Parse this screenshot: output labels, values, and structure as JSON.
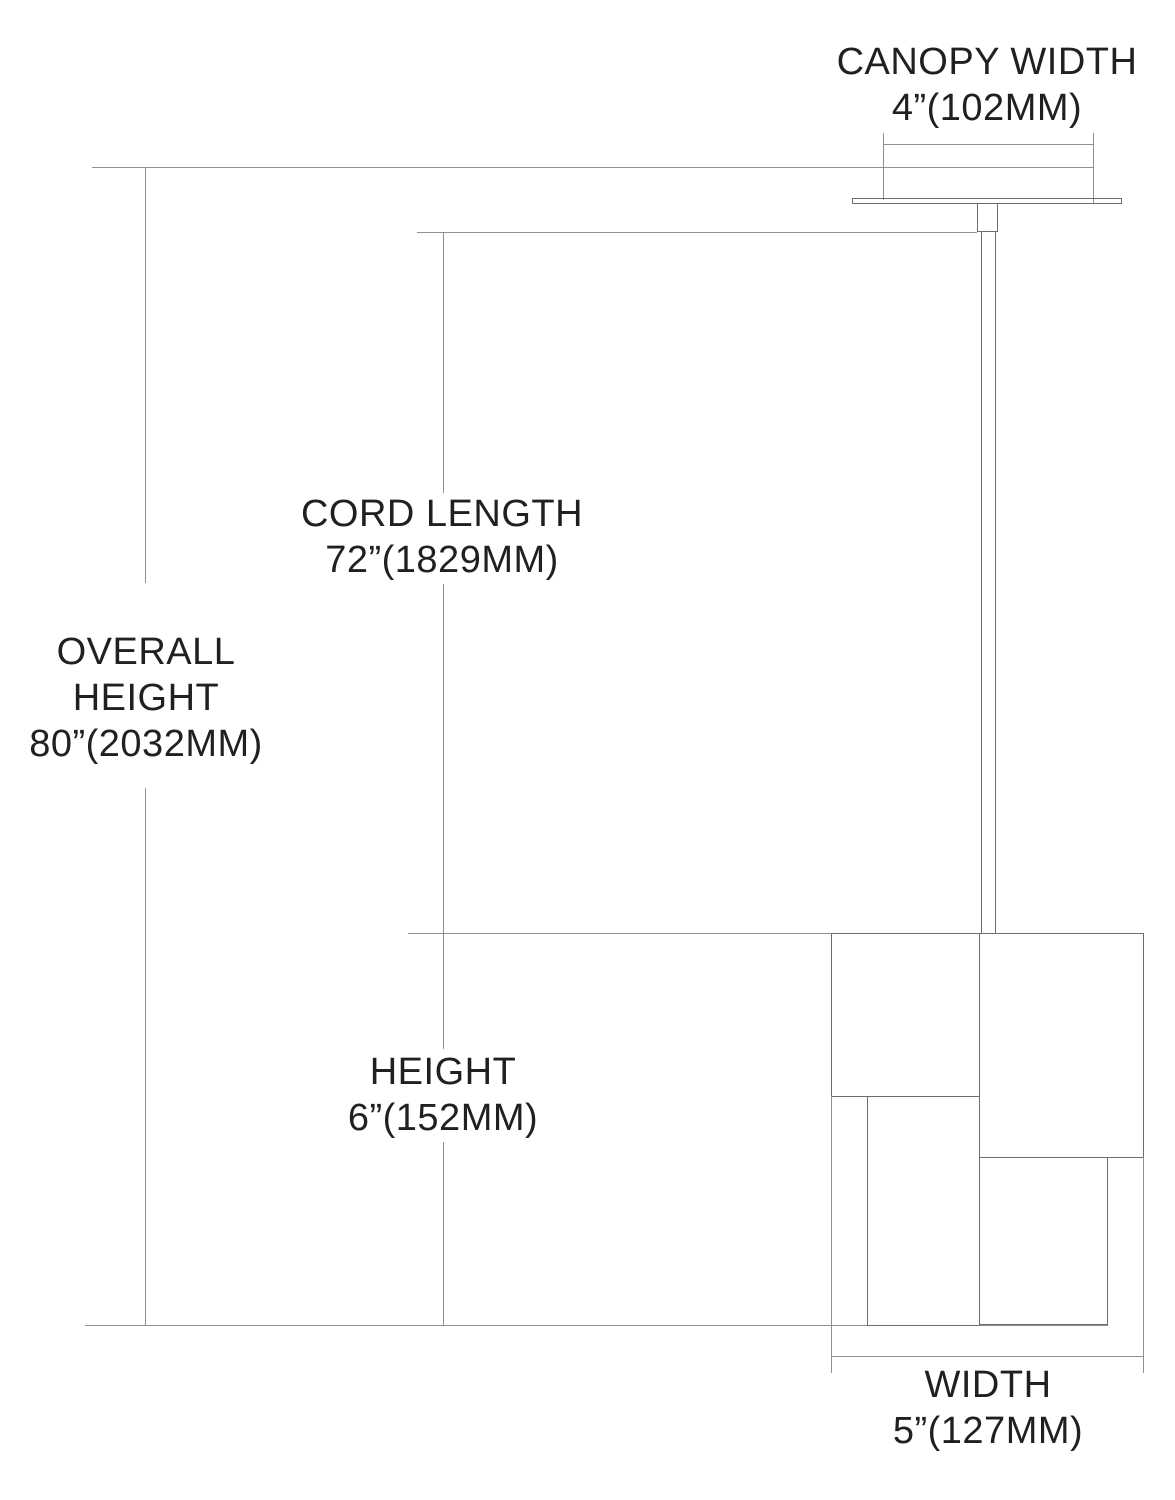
{
  "diagram": {
    "title": "pendant light fixture dimension drawing",
    "labels": {
      "canopy_width": {
        "title": "CANOPY WIDTH",
        "value": "4”(102MM)"
      },
      "cord_length": {
        "title": "CORD LENGTH",
        "value": "72”(1829MM)"
      },
      "overall_height": {
        "line1": "OVERALL",
        "line2": "HEIGHT",
        "value": "80”(2032MM)"
      },
      "height": {
        "title": "HEIGHT",
        "value": "6”(152MM)"
      },
      "width": {
        "title": "WIDTH",
        "value": "5”(127MM)"
      }
    },
    "colors": {
      "background": "#ffffff",
      "reference_line": "#8f8f8f",
      "outline": "#6d6d6d",
      "text": "#231f20"
    }
  }
}
